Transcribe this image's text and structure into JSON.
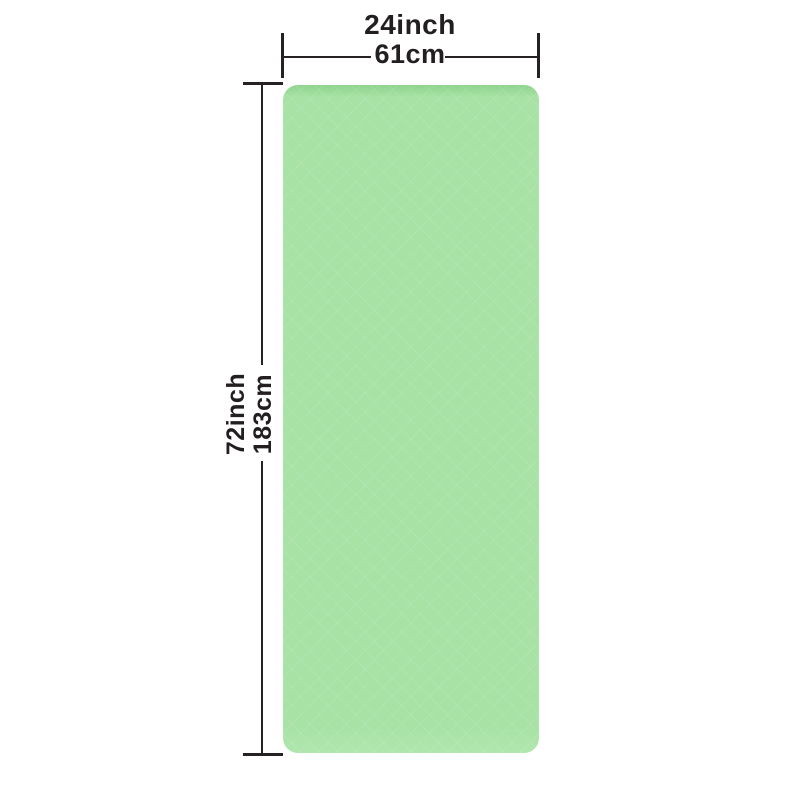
{
  "product": {
    "kind": "yoga-mat-dimension-diagram",
    "colors": {
      "mat": "#a8e2a5",
      "mat_edge": "#8ed38e",
      "line": "#262222",
      "text": "#231f20",
      "bg": "#ffffff"
    }
  },
  "dimensions": {
    "width": {
      "inch": "24inch",
      "cm": "61cm"
    },
    "height": {
      "inch": "72inch",
      "cm": "183cm"
    }
  }
}
